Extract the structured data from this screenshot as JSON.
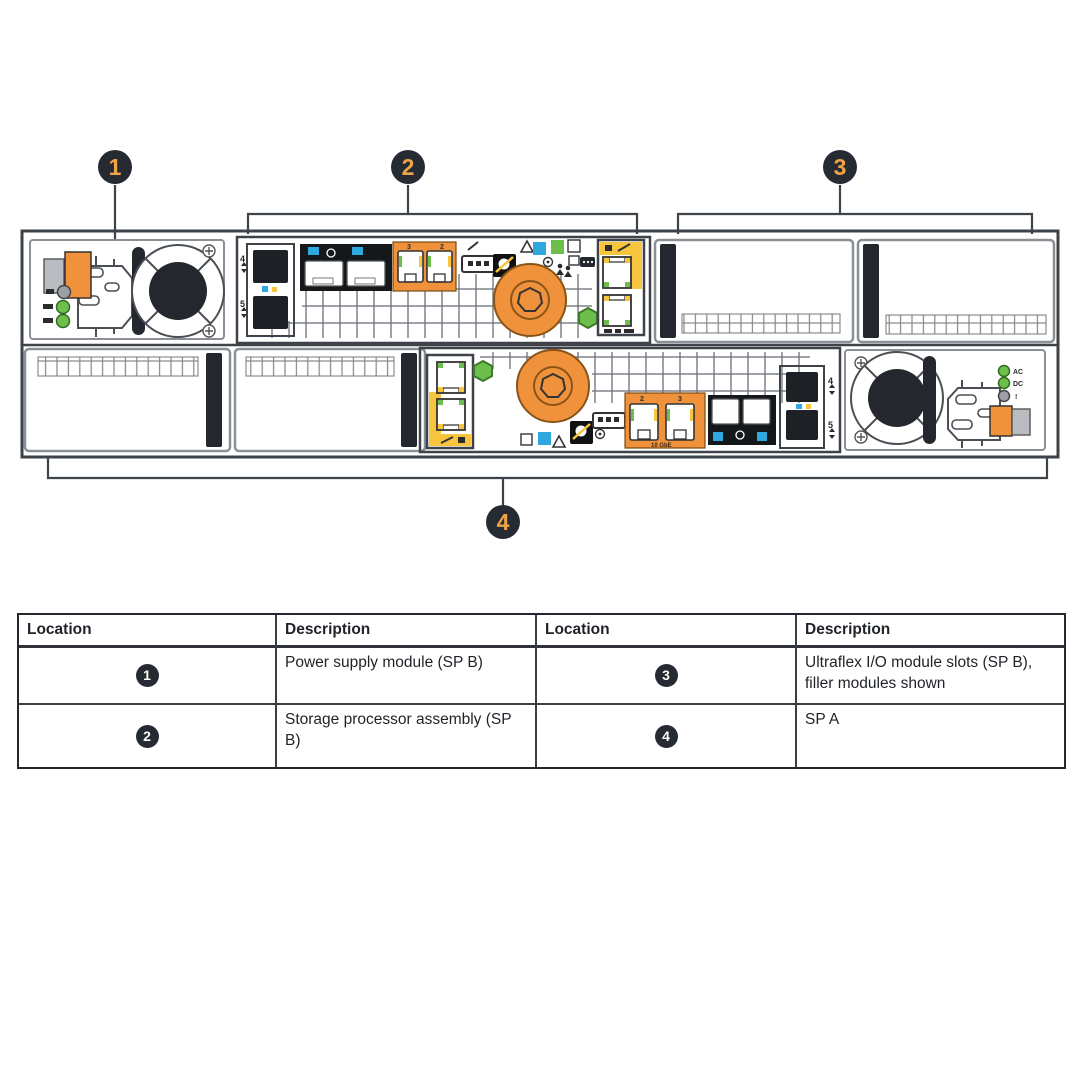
{
  "colors": {
    "orange": "#F0923B",
    "yellow": "#F7C63E",
    "green": "#6DBE4B",
    "blue": "#2FA8E0",
    "panel": "#15181B",
    "dark": "#24282E",
    "grey-part": "#B9BCC0",
    "callout-bg": "#262B33",
    "callout-num": "#F0A445",
    "line": "#3E434A",
    "module-border": "#8B9096"
  },
  "diagram": {
    "callouts": [
      {
        "n": "1"
      },
      {
        "n": "2"
      },
      {
        "n": "3"
      },
      {
        "n": "4"
      }
    ],
    "labels": {
      "spb_sfp_top": "4",
      "spb_sfp_bottom": "5",
      "spb_eth_left": "3",
      "spb_eth_right": "2",
      "spa_eth_left": "2",
      "spa_eth_right": "3",
      "spa_sfp_top": "4",
      "spa_sfp_bottom": "5",
      "spa_10gbe": "10 GbE",
      "psu_led_ac": "AC",
      "psu_led_dc": "DC",
      "psu_led_fault": "!"
    }
  },
  "table": {
    "headers": [
      "Location",
      "Description",
      "Location",
      "Description"
    ],
    "rows": [
      {
        "loc_a": "1",
        "desc_a": "Power supply module (SP B)",
        "loc_b": "3",
        "desc_b": "Ultraflex I/O module slots (SP B), filler modules shown"
      },
      {
        "loc_a": "2",
        "desc_a": "Storage processor assembly (SP B)",
        "loc_b": "4",
        "desc_b": "SP A"
      }
    ]
  }
}
